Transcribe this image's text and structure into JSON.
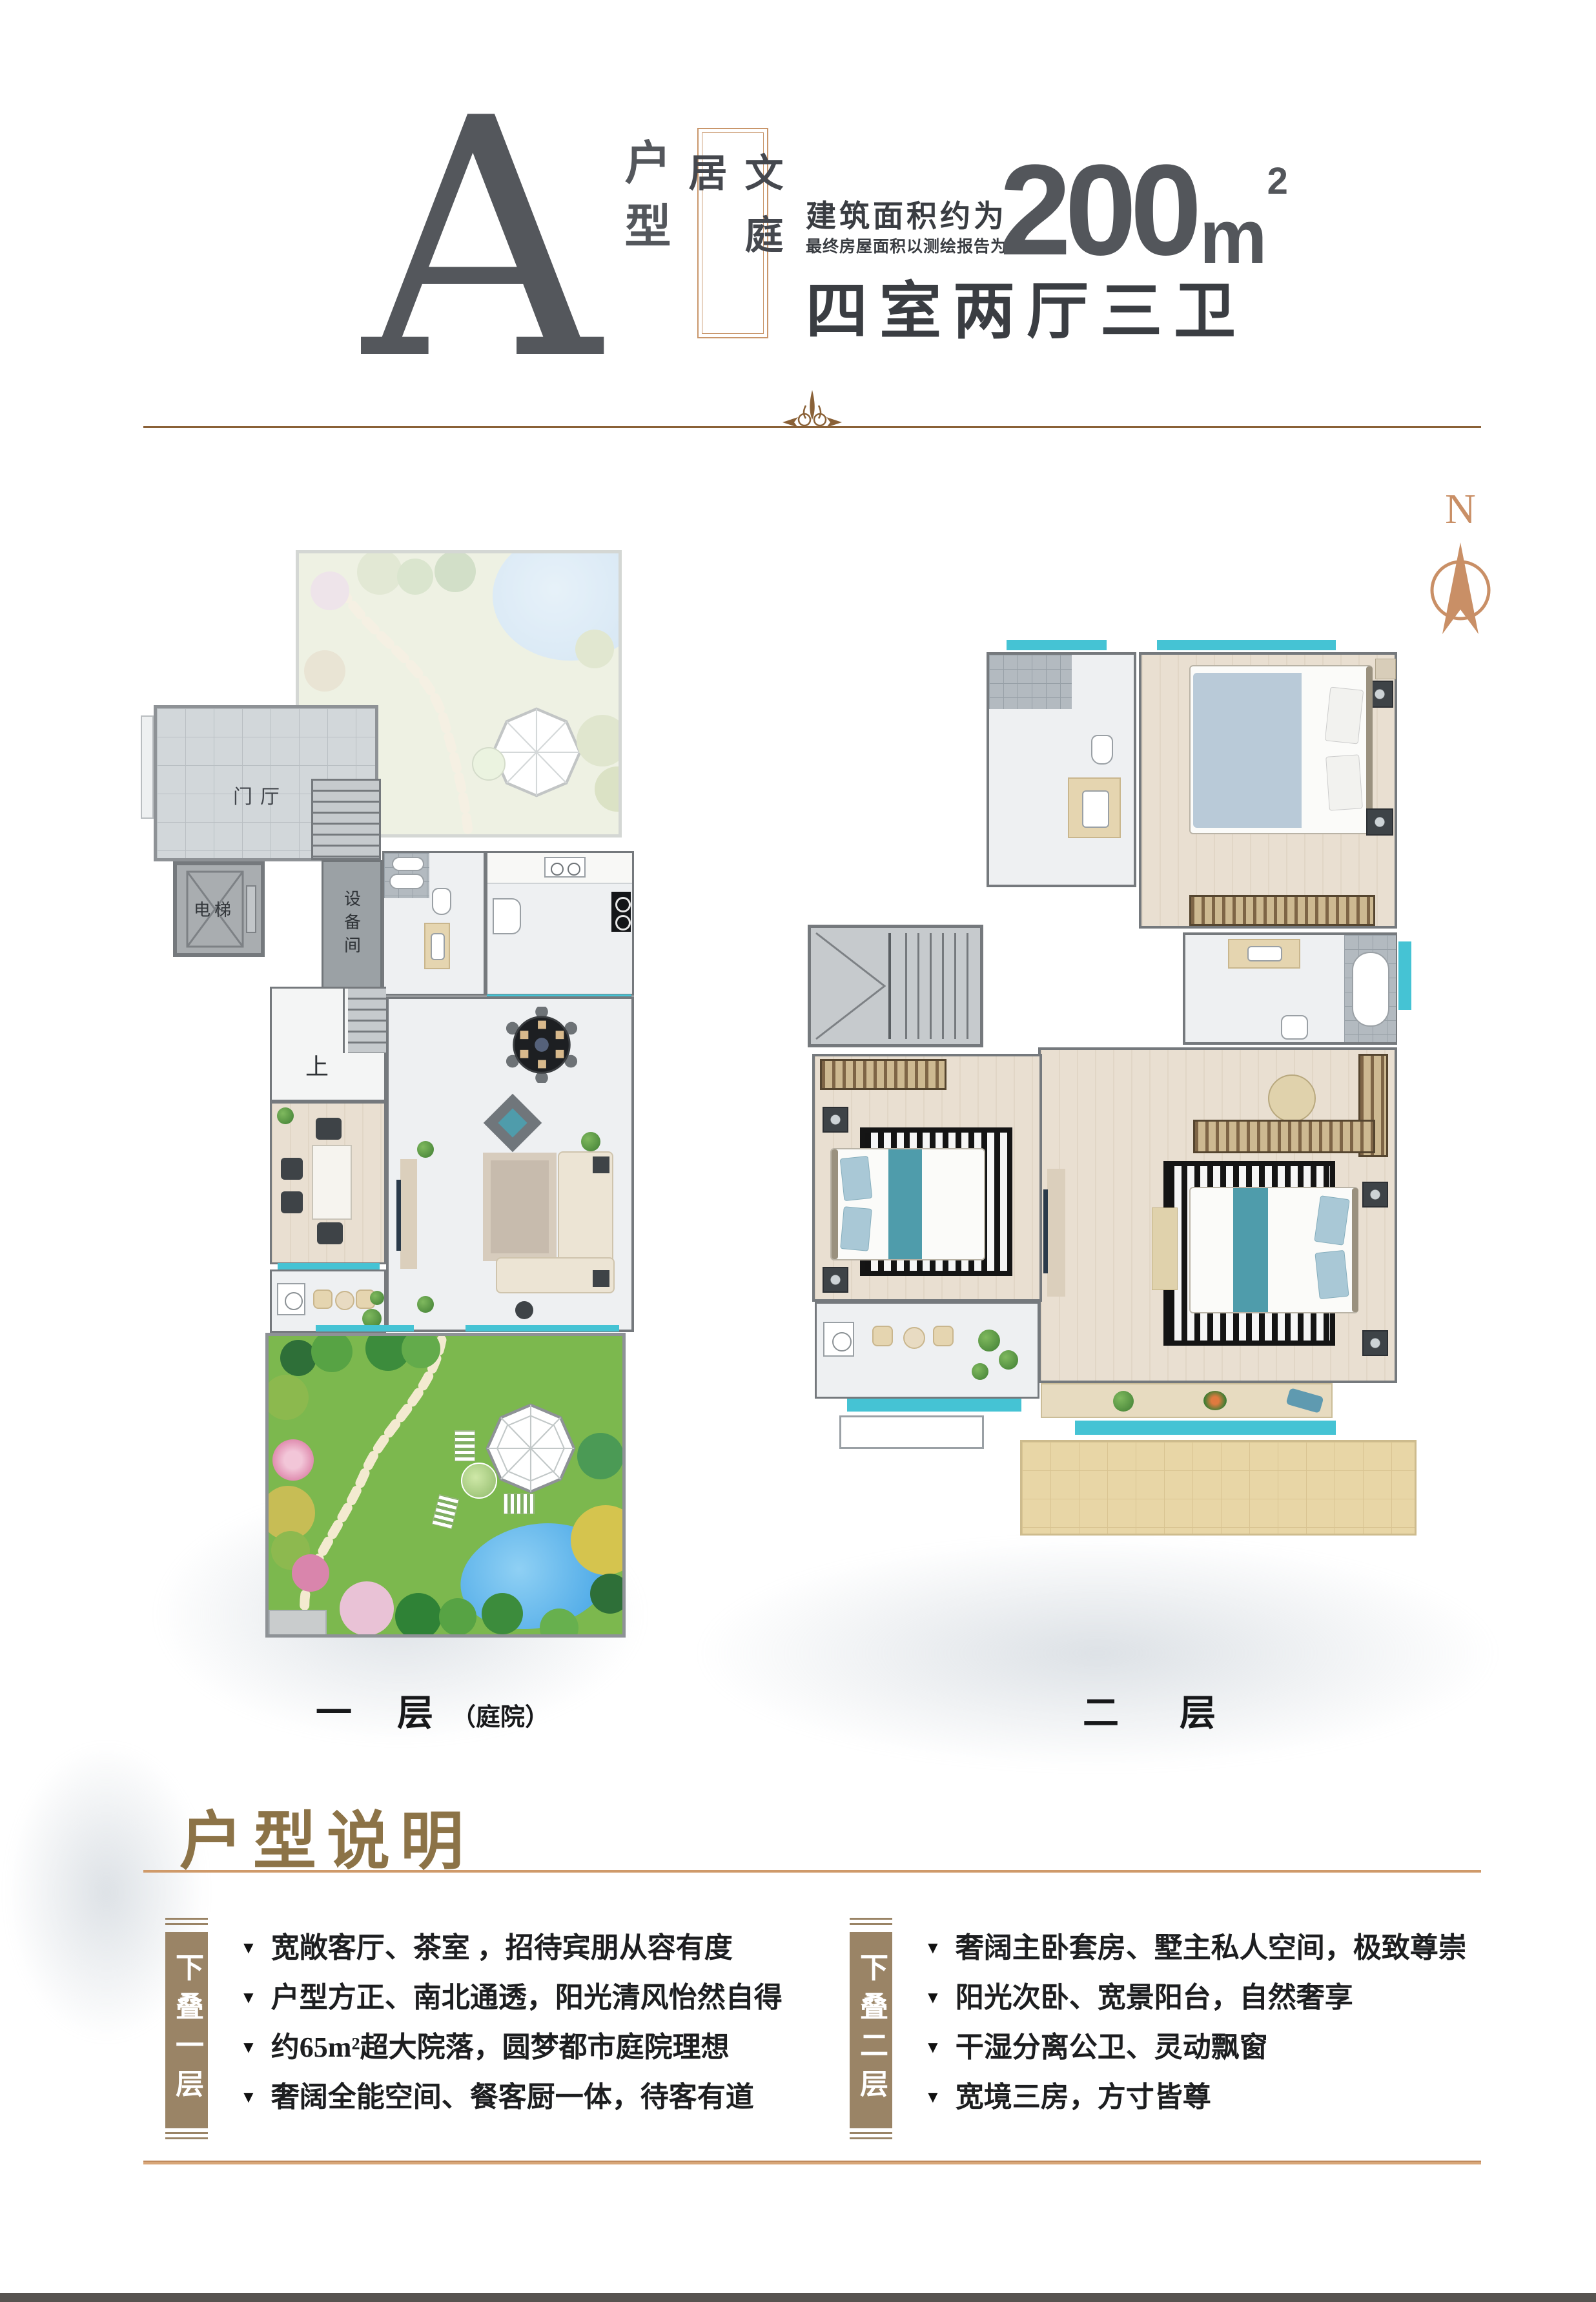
{
  "header": {
    "unit_letter": "A",
    "unit_type": "户型",
    "product_name": "文庭居",
    "area_prefix": "建筑面积约为",
    "area_note": "最终房屋面积以测绘报告为准",
    "area_value": "200",
    "area_unit": "m",
    "area_unit_sup": "2",
    "layout_summary": "四室两厅三卫"
  },
  "compass": {
    "north": "N"
  },
  "floor1": {
    "caption_main": "一 层",
    "caption_sub": "（庭院）",
    "labels": {
      "entry": "门厅",
      "elevator": "电梯",
      "equipment": "设备间",
      "up": "上"
    }
  },
  "floor2": {
    "caption": "二 层"
  },
  "notes": {
    "title": "户型说明",
    "bullet_glyph": "▼",
    "col1": {
      "tag": "下叠一层",
      "items": [
        "宽敞客厅、茶室 ，招待宾朋从容有度",
        "户型方正、南北通透，阳光清风怡然自得",
        "约65m²超大院落，圆梦都市庭院理想",
        "奢阔全能空间、餐客厨一体，待客有道"
      ]
    },
    "col2": {
      "tag": "下叠二层",
      "items": [
        "奢阔主卧套房、墅主私人空间，极致尊崇",
        "阳光次卧、宽景阳台，自然奢享",
        "干湿分离公卫、灵动飘窗",
        "宽境三房，方寸皆尊"
      ]
    }
  },
  "colors": {
    "accent_gold": "#c9966b",
    "bronze_title": "#8c7347",
    "divider_brown": "#8a6137",
    "underline_gold": "#cf9a6a",
    "bottom_line": "#d8a678",
    "tag_box": "#9a8466",
    "window_teal": "#45c3d4",
    "wall_grey": "#7d8185",
    "letter_grey": "#54575c",
    "grass_green": "#7cb84e",
    "pond_blue": "#4aa9e8",
    "compass_copper": "#c98f66",
    "footer_bar": "#575350"
  }
}
